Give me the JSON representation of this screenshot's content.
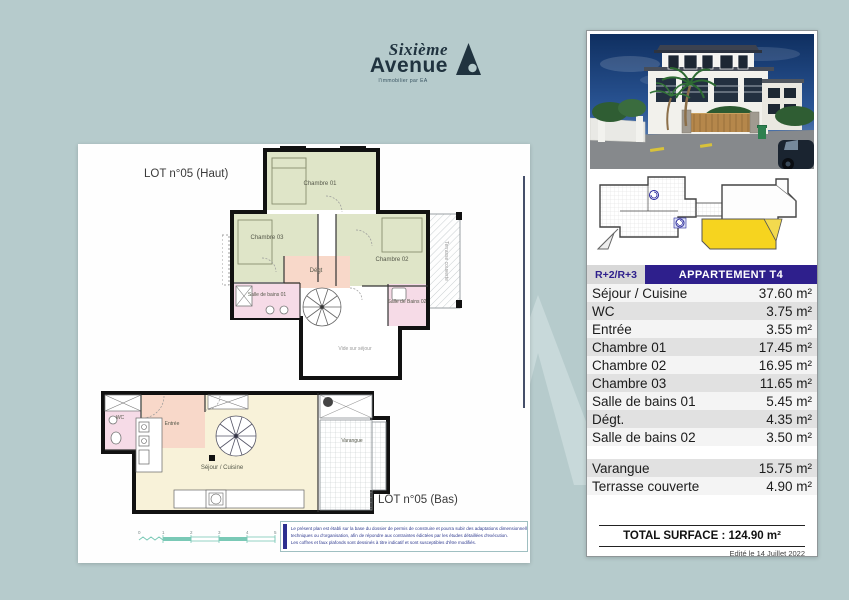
{
  "canvas": {
    "background_color": "#b6cbcc"
  },
  "logo": {
    "name_top": "Sixième",
    "name_bottom": "Avenue",
    "tagline": "l'immobilier par EA",
    "color": "#20333f"
  },
  "sheet": {
    "lot_haut": "LOT n°05 (Haut)",
    "lot_bas": "LOT n°05 (Bas)",
    "rooms": {
      "chambre01": "Chambre 01",
      "chambre02": "Chambre 02",
      "chambre03": "Chambre 03",
      "degt": "Dégt",
      "sdb01": "Salle de bains 01",
      "sdb02": "Salle de Bains 02",
      "vide": "Vide sur séjour",
      "terrasse": "Terrasse couverte",
      "wc": "WC",
      "entree": "Entrée",
      "sejour": "Séjour / Cuisine",
      "varangue": "Varangue"
    },
    "scale_ticks": [
      "0",
      "1",
      "2",
      "3",
      "4",
      "5"
    ],
    "disclaimer": {
      "line1": "Le présent plan est établi sur la base du dossier de permis de construire et pourra subir des adaptations dimensionnelles,",
      "line2": "techniques ou d'organisation, afin de répondre aux contraintes édictées par les études détaillées d'exécution.",
      "line3": "Les coffres et faux plafonds sont dessinés à titre indicatif et sont susceptibles d'être modifiés."
    }
  },
  "panel": {
    "level": "R+2/R+3",
    "title": "APPARTEMENT T4",
    "rows": [
      {
        "label": "Séjour / Cuisine",
        "area": "37.60 m²"
      },
      {
        "label": "WC",
        "area": "3.75 m²"
      },
      {
        "label": "Entrée",
        "area": "3.55 m²"
      },
      {
        "label": "Chambre 01",
        "area": "17.45 m²"
      },
      {
        "label": "Chambre 02",
        "area": "16.95 m²"
      },
      {
        "label": "Chambre 03",
        "area": "11.65 m²"
      },
      {
        "label": "Salle de bains 01",
        "area": "5.45 m²"
      },
      {
        "label": "Dégt.",
        "area": "4.35 m²"
      },
      {
        "label": "Salle de bains 02",
        "area": "3.50 m²"
      },
      {
        "label": "Varangue",
        "area": "15.75 m²"
      },
      {
        "label": "Terrasse couverte",
        "area": "4.90 m²"
      }
    ],
    "total": "TOTAL SURFACE : 124.90 m²",
    "edited": "Edité le 14 Juillet 2022",
    "colors": {
      "header_navy": "#2e1f8c",
      "highlight_yellow": "#f6d41f",
      "row_gray": "#e1e1e1"
    }
  }
}
